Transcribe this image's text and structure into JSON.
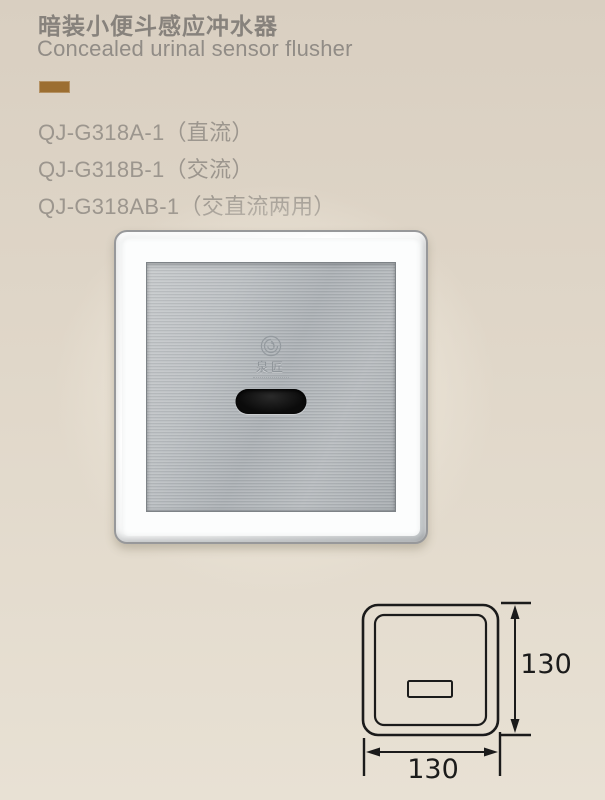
{
  "page": {
    "background_top": "#d9cfc1",
    "background_bottom": "#e8e1d4"
  },
  "header": {
    "title_zh": "暗装小便斗感应冲水器",
    "title_en": "Concealed urinal sensor flusher",
    "accent_color": "#9c6e31"
  },
  "models": [
    {
      "label": "QJ-G318A-1（直流）"
    },
    {
      "label": "QJ-G318B-1（交流）"
    },
    {
      "label": "QJ-G318AB-1（交直流两用）"
    }
  ],
  "product": {
    "brand_zh": "泉匠",
    "colors": {
      "chrome_frame": "#fcfdfd",
      "steel_plate": "#b3b7ba",
      "sensor_window": "#0b0b0b"
    }
  },
  "drawing": {
    "height_label": "130",
    "width_label": "130",
    "line_color": "#1b1b1b"
  }
}
